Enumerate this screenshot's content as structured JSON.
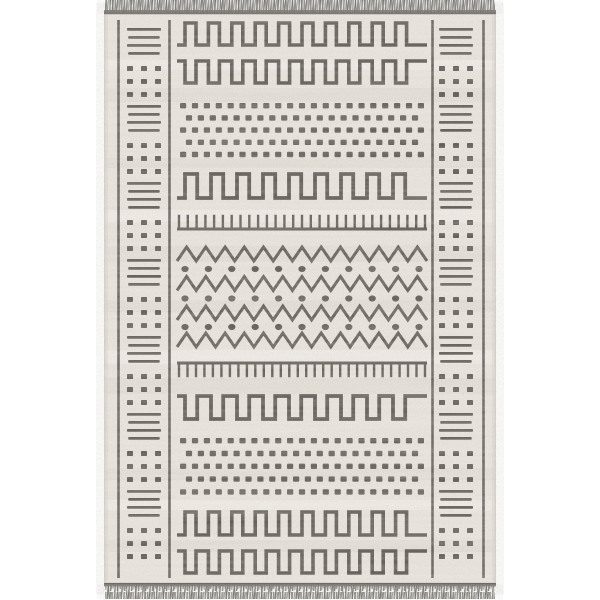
{
  "image": {
    "description": "Product photo of a cream and charcoal geometric Moroccan-style flatweave area rug with gray tassel fringe on top and bottom edges, on a white background",
    "background_color": "#ffffff"
  },
  "rug": {
    "fabric_color": "#eae5de",
    "fabric_edge_color": "#d3cec6",
    "fabric_streak_color": "#d8d1c7",
    "highlight_color": "#f7f4ef",
    "pattern_color": "#443f39",
    "fringe_strand_colors": [
      "#8d8b86",
      "#a8a6a1",
      "#76746f"
    ],
    "fringe_band_color": "#7b7974",
    "fringe_band_dark": "#57544f",
    "x": 104,
    "width": 392,
    "top": 14,
    "bottom": 583,
    "streaks_dark": [
      [
        88,
        14
      ],
      [
        158,
        10
      ],
      [
        246,
        16
      ],
      [
        300,
        12
      ],
      [
        378,
        16
      ],
      [
        468,
        12
      ],
      [
        540,
        12
      ]
    ],
    "streaks_light": [
      [
        60,
        10
      ],
      [
        210,
        12
      ],
      [
        350,
        14
      ],
      [
        500,
        10
      ]
    ],
    "border": {
      "line_xs": [
        118.5,
        169.5,
        432.5,
        483.5
      ],
      "line_top": 20,
      "line_bottom": 578,
      "line_stroke": 2.6,
      "bar_x_left": 127,
      "bar_x_right": 439,
      "bar_w": 34,
      "bar_h": 2.7,
      "bar_spacing": 8,
      "bars_per_group": 4,
      "dot_x_left": 127,
      "dot_x_right": 439,
      "dot_size": 6,
      "dot_col_spacing": 14,
      "dot_row_spacing": 13,
      "dot_rows": 3,
      "dot_cols": 3,
      "first_group_y": 28,
      "group_period": 77,
      "dot_offset": 38,
      "pairs": 7
    },
    "field": {
      "x0": 177,
      "x1": 427,
      "rows": [
        {
          "type": "sqwave",
          "dir": "up",
          "yt": 23,
          "yb": 45,
          "teeth": 10,
          "stub": 8,
          "stroke": 3.6
        },
        {
          "type": "sqwave",
          "dir": "down",
          "yt": 61,
          "yb": 83,
          "teeth": 10,
          "stub": 8,
          "stroke": 3.6
        },
        {
          "type": "dotgrid",
          "y": 103,
          "rows": 5,
          "row_spacing": 12.2,
          "cols": 21,
          "dot_w": 6.2,
          "dot_h": 5.4
        },
        {
          "type": "sqwave",
          "dir": "up",
          "yt": 174,
          "yb": 198,
          "teeth": 9,
          "stub": 8,
          "stroke": 3.8
        },
        {
          "type": "comb",
          "dir": "up",
          "y": 229,
          "tick_h": 13,
          "ticks": 29,
          "stroke": 3,
          "tick_stroke": 2.4
        },
        {
          "type": "zigzag",
          "yc": 254,
          "amp": 7,
          "periods": 13,
          "stroke": 3
        },
        {
          "type": "dotrow",
          "y": 269,
          "dots": 11,
          "rx": 3.6,
          "ry": 3.1
        },
        {
          "type": "zigzag",
          "yc": 283.5,
          "amp": 7,
          "periods": 13,
          "stroke": 3
        },
        {
          "type": "dotrow",
          "y": 298.5,
          "dots": 11,
          "rx": 3.6,
          "ry": 3.1
        },
        {
          "type": "zigzag",
          "yc": 313,
          "amp": 7,
          "periods": 13,
          "stroke": 3
        },
        {
          "type": "dotrow",
          "y": 327,
          "dots": 11,
          "rx": 3.6,
          "ry": 3.1
        },
        {
          "type": "zigzag",
          "yc": 340,
          "amp": 7,
          "periods": 13,
          "stroke": 3
        },
        {
          "type": "comb",
          "dir": "down",
          "y": 363,
          "tick_h": 13,
          "ticks": 30,
          "stroke": 3,
          "tick_stroke": 2.4
        },
        {
          "type": "sqwave",
          "dir": "down",
          "yt": 396,
          "yb": 419,
          "teeth": 9,
          "stub": 8,
          "stroke": 3.8
        },
        {
          "type": "dotgrid",
          "y": 438,
          "rows": 5,
          "row_spacing": 12.8,
          "cols": 21,
          "dot_w": 6.2,
          "dot_h": 5.4
        },
        {
          "type": "sqwave",
          "dir": "up",
          "yt": 512,
          "yb": 535,
          "teeth": 10,
          "stub": 8,
          "stroke": 3.6
        },
        {
          "type": "sqwave",
          "dir": "down",
          "yt": 551,
          "yb": 573,
          "teeth": 10,
          "stub": 8,
          "stroke": 3.6
        }
      ]
    },
    "fringe": {
      "top_y": 0,
      "top_h": 13,
      "band_top_y": 10,
      "bottom_y": 583,
      "bottom_h": 16,
      "band_bottom_y": 583
    }
  }
}
